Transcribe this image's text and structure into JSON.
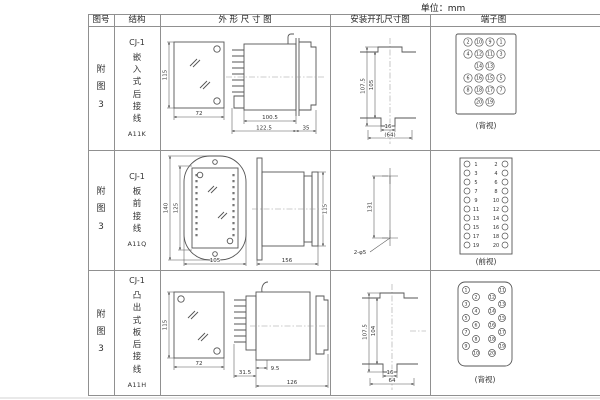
{
  "unit_label": "单位：mm",
  "headers": {
    "figure": "图号",
    "structure": "结构",
    "outline": "外 形 尺 寸 图",
    "install": "安装开孔尺寸图",
    "terminal": "端子图"
  },
  "rows": [
    {
      "figure_no": "附图3",
      "model": "CJ-1",
      "structure_type": "嵌入式后接线",
      "code": "A11K",
      "outline": {
        "h": "115",
        "w": "72",
        "d1": "100.5",
        "d2": "122.5",
        "d3": "35"
      },
      "install": {
        "v1": "107.5",
        "v2": "105",
        "w1": "16",
        "w2": "(64)"
      },
      "terminal": {
        "label": "(背视)",
        "n": [
          "2",
          "10",
          "9",
          "1",
          "4",
          "12",
          "11",
          "3",
          "14",
          "13",
          "6",
          "16",
          "15",
          "5",
          "8",
          "18",
          "17",
          "7",
          "20",
          "19"
        ]
      }
    },
    {
      "figure_no": "附图3",
      "model": "CJ-1",
      "structure_type": "板前接线",
      "code": "A11Q",
      "outline": {
        "h1": "140",
        "h2": "125",
        "w": "105",
        "len": "156",
        "side_h": "115"
      },
      "install": {
        "spacing": "131",
        "holes": "2-φ5"
      },
      "terminal": {
        "label": "(前视)",
        "left": [
          "1",
          "3",
          "5",
          "7",
          "9",
          "11",
          "13",
          "15",
          "17",
          "19"
        ],
        "right": [
          "2",
          "4",
          "6",
          "8",
          "10",
          "12",
          "14",
          "16",
          "18",
          "20"
        ]
      }
    },
    {
      "figure_no": "附图3",
      "model": "CJ-1",
      "structure_type": "凸出式板后接线",
      "code": "A11H",
      "outline": {
        "h": "115",
        "w": "72",
        "d1": "9.5",
        "d2": "31.5",
        "d3": "126"
      },
      "install": {
        "v1": "107.5",
        "v2": "104",
        "w1": "16",
        "w2": "64"
      },
      "terminal": {
        "label": "(背视)",
        "n": [
          "1",
          "3",
          "5",
          "7",
          "9",
          "2",
          "4",
          "6",
          "8",
          "10",
          "12",
          "14",
          "16",
          "18",
          "20",
          "11",
          "13",
          "15",
          "17",
          "19"
        ]
      }
    }
  ]
}
